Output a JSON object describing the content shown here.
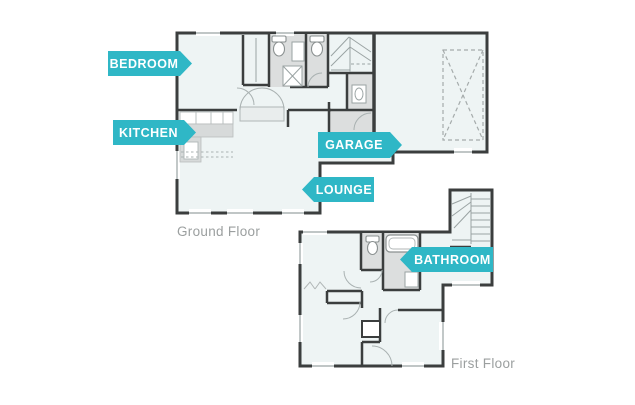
{
  "diagram": {
    "type": "floor-plan",
    "floors": [
      "Ground Floor",
      "First Floor"
    ]
  },
  "labels": {
    "bedroom": {
      "text": "BEDROOM",
      "arrow": "right"
    },
    "kitchen": {
      "text": "KITCHEN",
      "arrow": "right"
    },
    "garage": {
      "text": "GARAGE",
      "arrow": "right"
    },
    "lounge": {
      "text": "LOUNGE",
      "arrow": "left"
    },
    "bathroom": {
      "text": "BATHROOM",
      "arrow": "left"
    }
  },
  "captions": {
    "ground_floor": "Ground Floor",
    "first_floor": "First Floor"
  },
  "colors": {
    "accent_teal": "#2fb7c6",
    "label_text": "#ffffff",
    "wall": "#3b3e3e",
    "floor_fill": "#eef4f4",
    "fixture_gray": "#dcdede",
    "caption_text": "#9b9f9f"
  }
}
